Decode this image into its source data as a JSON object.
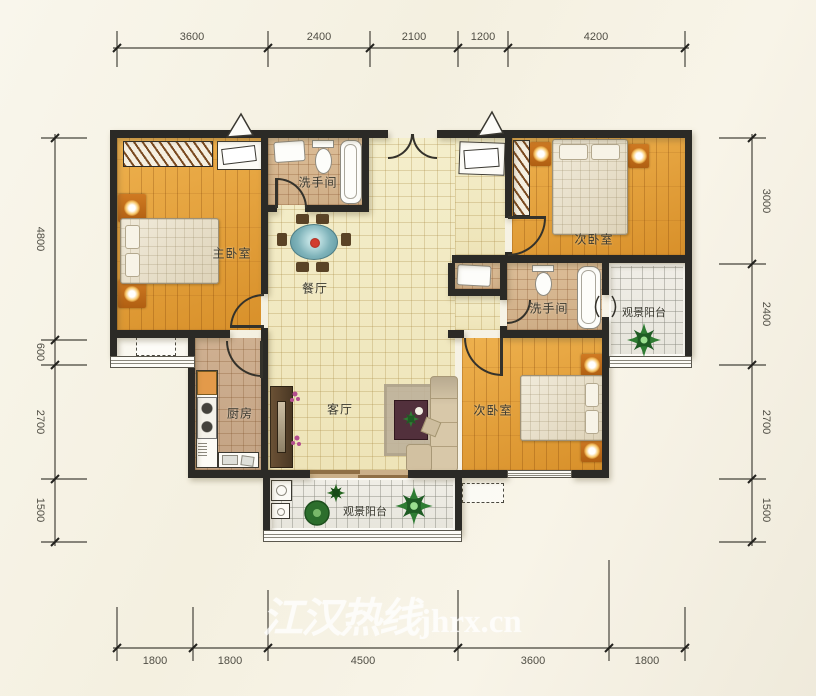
{
  "watermark": {
    "text_cn": "江汉热线",
    "text_en": "jhrx.cn"
  },
  "dimensions": {
    "top": [
      "3600",
      "2400",
      "2100",
      "1200",
      "4200"
    ],
    "bottom": [
      "1800",
      "1800",
      "4500",
      "3600",
      "1800"
    ],
    "left": [
      "4800",
      "600",
      "2700",
      "1500"
    ],
    "right": [
      "3000",
      "2400",
      "2700",
      "1500"
    ]
  },
  "rooms": {
    "master_bedroom": "主卧室",
    "bathroom_top": "洗手间",
    "bathroom_right": "洗手间",
    "bedroom_top_right": "次卧室",
    "bedroom_bottom_right": "次卧室",
    "dining": "餐厅",
    "kitchen": "厨房",
    "living": "客厅",
    "balcony_right": "观景阳台",
    "balcony_bottom": "观景阳台"
  },
  "colors": {
    "wall": "#2b2a26",
    "wood_floor": "#e2a03c",
    "tile_cream": "#f3ecca",
    "tile_tan": "#d2b28e",
    "balcony_tile": "#edebe3",
    "plant_green": "#2e7d32",
    "dining_table": "#6fa8b0",
    "background": "#f6f2e4"
  }
}
